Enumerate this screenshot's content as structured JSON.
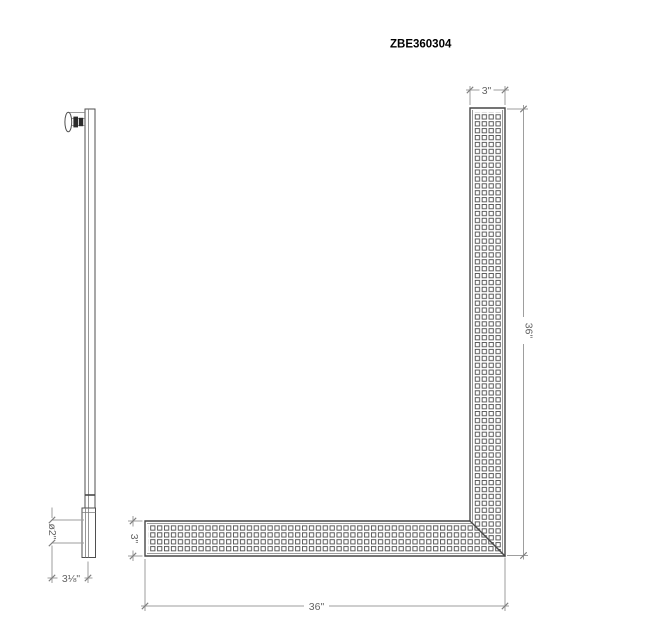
{
  "title": "ZBE360304",
  "views": {
    "front": {
      "name": "front-view",
      "dims": {
        "top_width": "3\"",
        "right_height": "36\"",
        "bottom_width": "36\"",
        "flange_height": "3\""
      }
    },
    "side": {
      "name": "side-view",
      "dims": {
        "hole_diameter": "ø2\"",
        "base_depth": "3⅛\""
      }
    }
  },
  "colors": {
    "background": "#ffffff",
    "part_edge": "#474747",
    "perforation": "#4f4f4f",
    "dimension_line": "#9e9e9e",
    "dimension_text": "#636363",
    "title_text": "#000000"
  }
}
